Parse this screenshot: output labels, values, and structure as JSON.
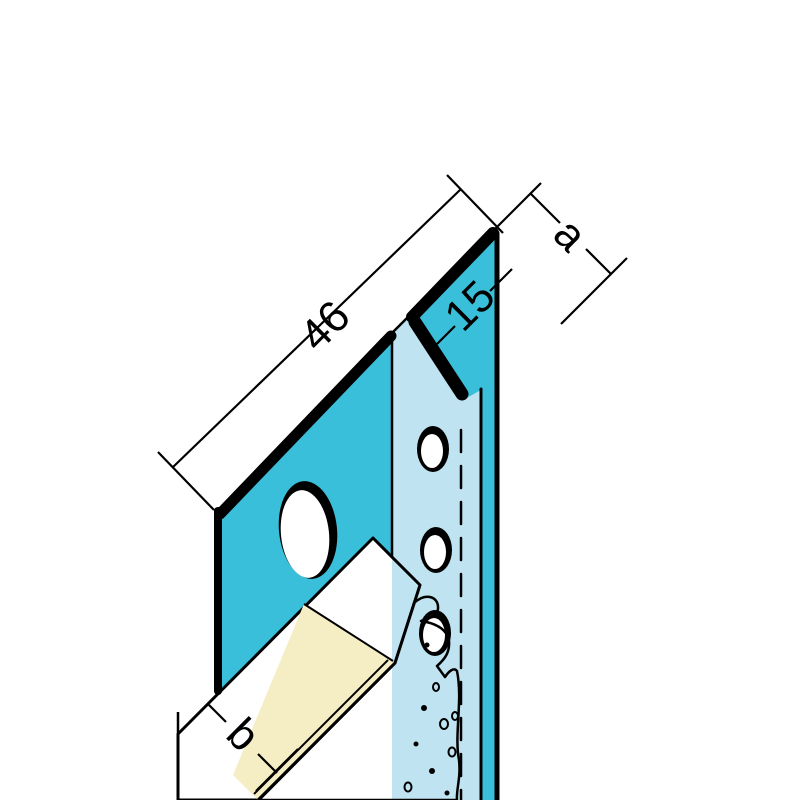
{
  "diagram": {
    "kind": "isometric technical drawing of a plasterboard edge profile with shadow gap",
    "dimensions": {
      "flange_width_label": "46",
      "gap_width_label": "15",
      "reveal_label": "a",
      "board_thickness_label": "b"
    },
    "colors": {
      "background": "#ffffff",
      "profile_teal": "#3abfdb",
      "profile_light_blue": "#bfe3f1",
      "board_cream": "#fbf7e3",
      "board_cream_shade": "#f5eec5",
      "outline": "#000000"
    }
  }
}
